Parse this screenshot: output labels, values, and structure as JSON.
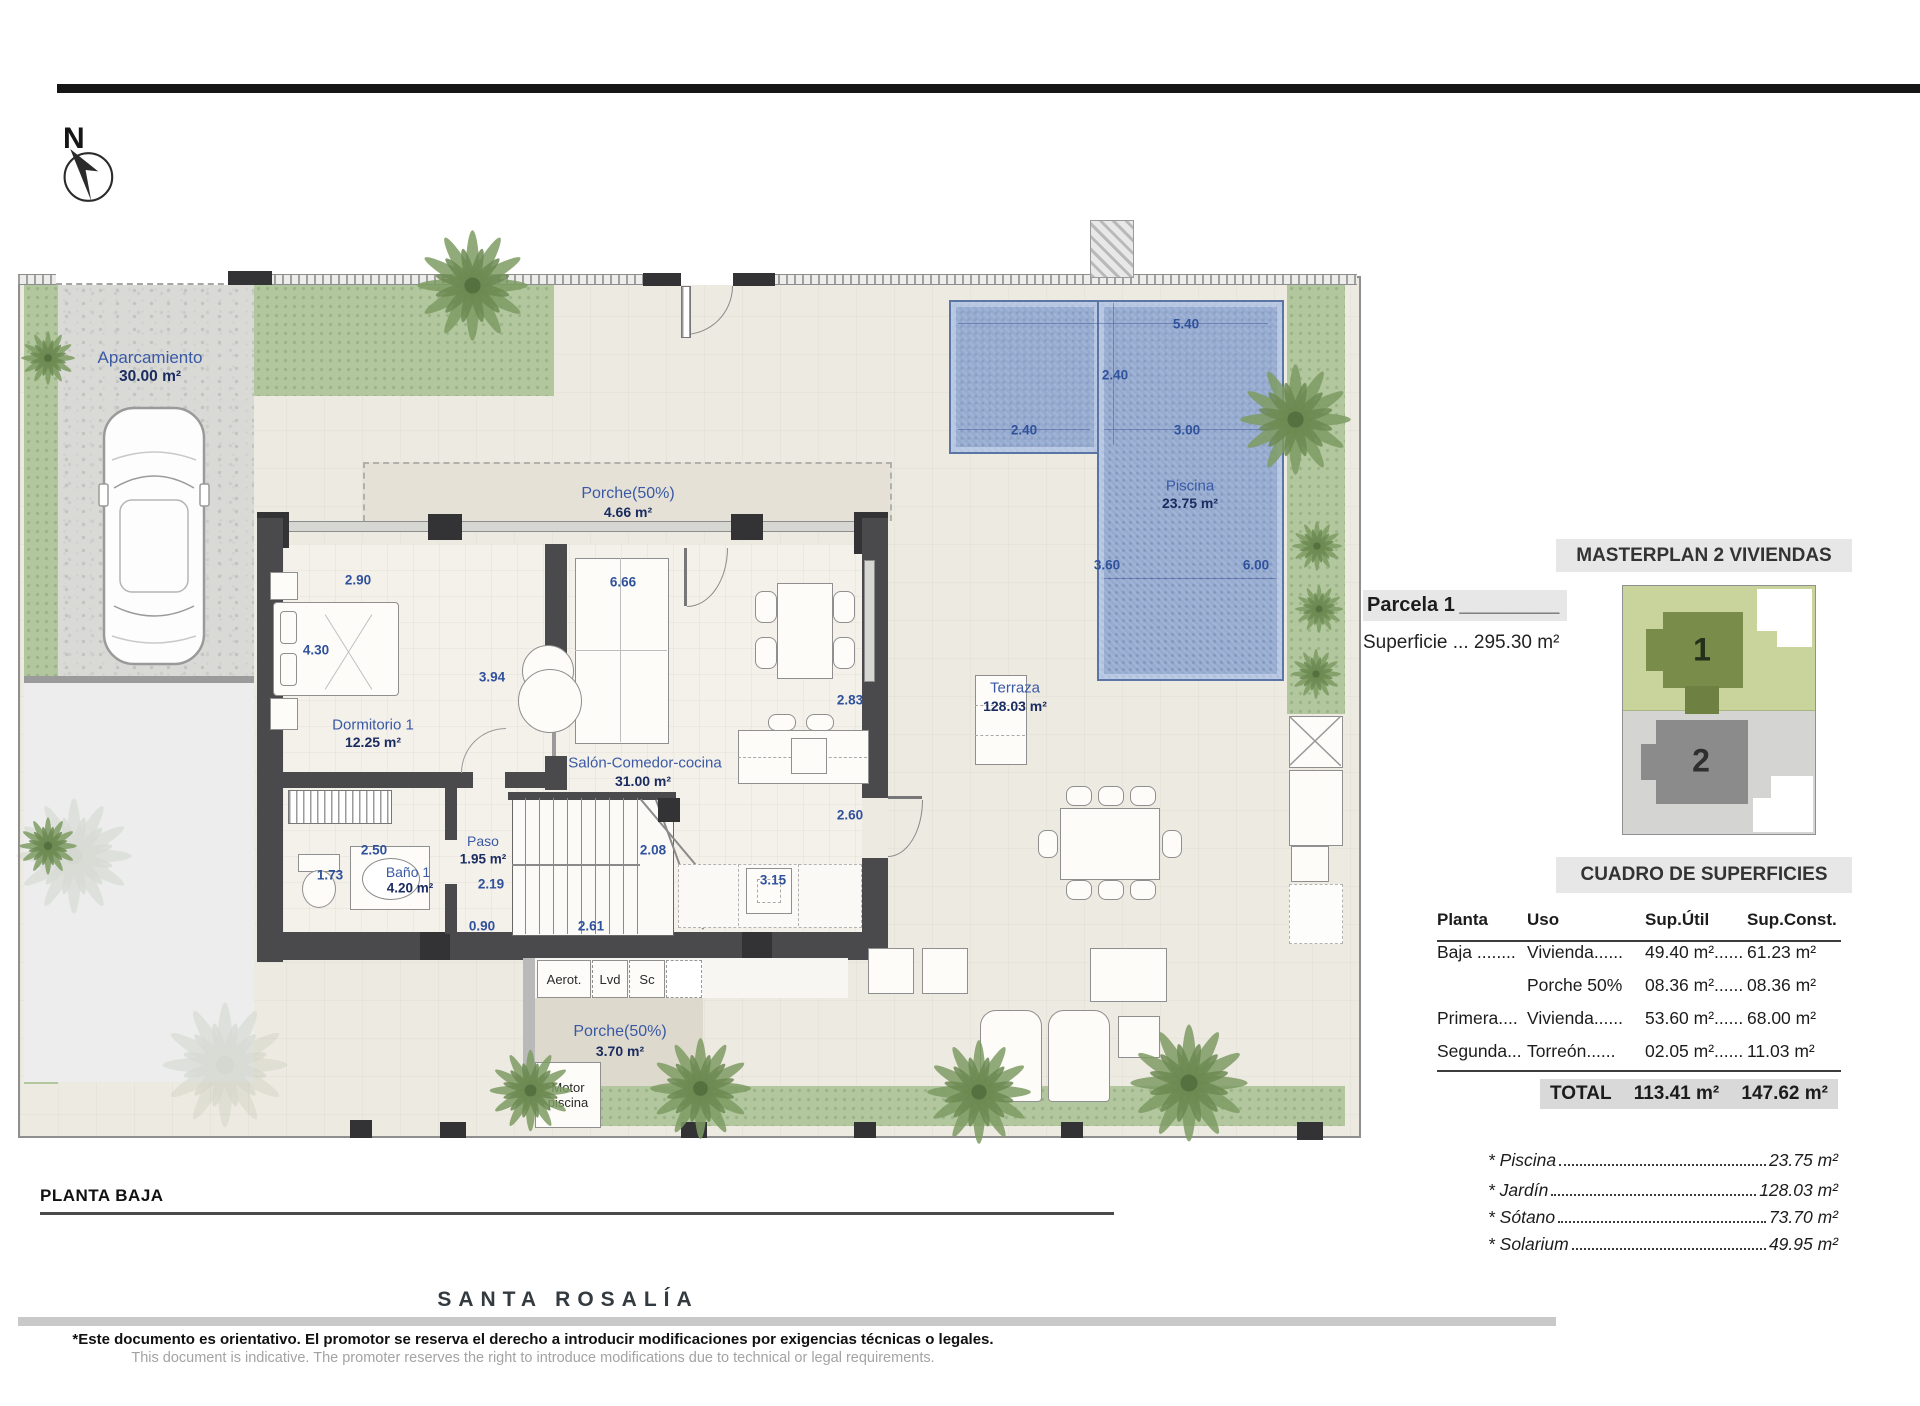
{
  "page": {
    "north_label": "N",
    "plan_title": "PLANTA BAJA"
  },
  "rooms": {
    "aparcamiento": {
      "name": "Aparcamiento",
      "area": "30.00 m²"
    },
    "porche_top": {
      "name": "Porche(50%)",
      "area": "4.66 m²"
    },
    "dormitorio1": {
      "name": "Dormitorio 1",
      "area": "12.25 m²"
    },
    "salon": {
      "name": "Salón-Comedor-cocina",
      "area": "31.00 m²"
    },
    "bano1": {
      "name": "Baño 1",
      "area": "4.20 m²"
    },
    "paso": {
      "name": "Paso",
      "area": "1.95 m²"
    },
    "terraza": {
      "name": "Terraza",
      "area": "128.03 m²"
    },
    "piscina": {
      "name": "Piscina",
      "area": "23.75 m²"
    },
    "porche_bottom": {
      "name": "Porche(50%)",
      "area": "3.70 m²"
    },
    "motor_piscina": {
      "line1": "Motor",
      "line2": "piscina"
    },
    "utility_boxes": {
      "box1": "Aerot.",
      "box2": "Lvd",
      "box3": "Sc"
    }
  },
  "dims": {
    "d1": "5.40",
    "d2": "2.40",
    "d3": "2.40",
    "d4": "3.00",
    "d5": "3.60",
    "d6": "6.00",
    "d7": "2.90",
    "d8": "6.66",
    "d9": "4.30",
    "d10": "3.94",
    "d11": "2.83",
    "d12": "2.60",
    "d13": "2.50",
    "d14": "2.08",
    "d15": "1.73",
    "d16": "2.19",
    "d17": "0.90",
    "d18": "2.61",
    "d19": "3.15"
  },
  "masterplan": {
    "title": "MASTERPLAN 2 VIVIENDAS",
    "parcela_label": "Parcela 1",
    "parcela_line": "_________",
    "superficie_label": "Superficie ... 295.30 m²",
    "unit1": "1",
    "unit2": "2"
  },
  "cuadro": {
    "title": "CUADRO DE SUPERFICIES",
    "headers": {
      "planta": "Planta",
      "uso": "Uso",
      "util": "Sup.Útil",
      "const": "Sup.Const."
    },
    "rows": [
      {
        "planta": "Baja ........",
        "uso": "Vivienda......",
        "util": "49.40 m²......",
        "const": "61.23 m²"
      },
      {
        "planta": "",
        "uso": "Porche 50%",
        "util": "08.36 m²......",
        "const": "08.36 m²"
      },
      {
        "planta": "Primera....",
        "uso": "Vivienda......",
        "util": "53.60 m²......",
        "const": "68.00 m²"
      },
      {
        "planta": "Segunda...",
        "uso": "Torreón......",
        "util": "02.05 m²......",
        "const": "11.03 m²"
      }
    ],
    "total": {
      "label": "TOTAL",
      "util": "113.41 m²",
      "const": "147.62 m²"
    }
  },
  "extras": {
    "items": [
      {
        "label": "* Piscina",
        "value": "23.75 m²"
      },
      {
        "label": "* Jardín",
        "value": "128.03 m²"
      },
      {
        "label": "* Sótano",
        "value": "73.70 m²"
      },
      {
        "label": "* Solarium",
        "value": "49.95 m²"
      }
    ]
  },
  "footer": {
    "brand": "SANTA ROSALÍA",
    "disclaimer_es": "*Este documento es orientativo. El promotor se reserva el derecho a introducir modificaciones por exigencias técnicas o legales.",
    "disclaimer_en": "This document is indicative. The promoter reserves the right to introduce modifications due to technical or legal requirements."
  },
  "colors": {
    "dim_blue": "#30519c",
    "pool_blue": "#96abd0",
    "garden_green": "#b2c79e",
    "wall_dark": "#4a4a4c",
    "masterplan_green": "#c8d49c",
    "masterplan_gray": "#d4d4d2"
  },
  "icons": {
    "north_arrow": "compass-needle-nw",
    "palm": "palm-tree-starburst"
  }
}
